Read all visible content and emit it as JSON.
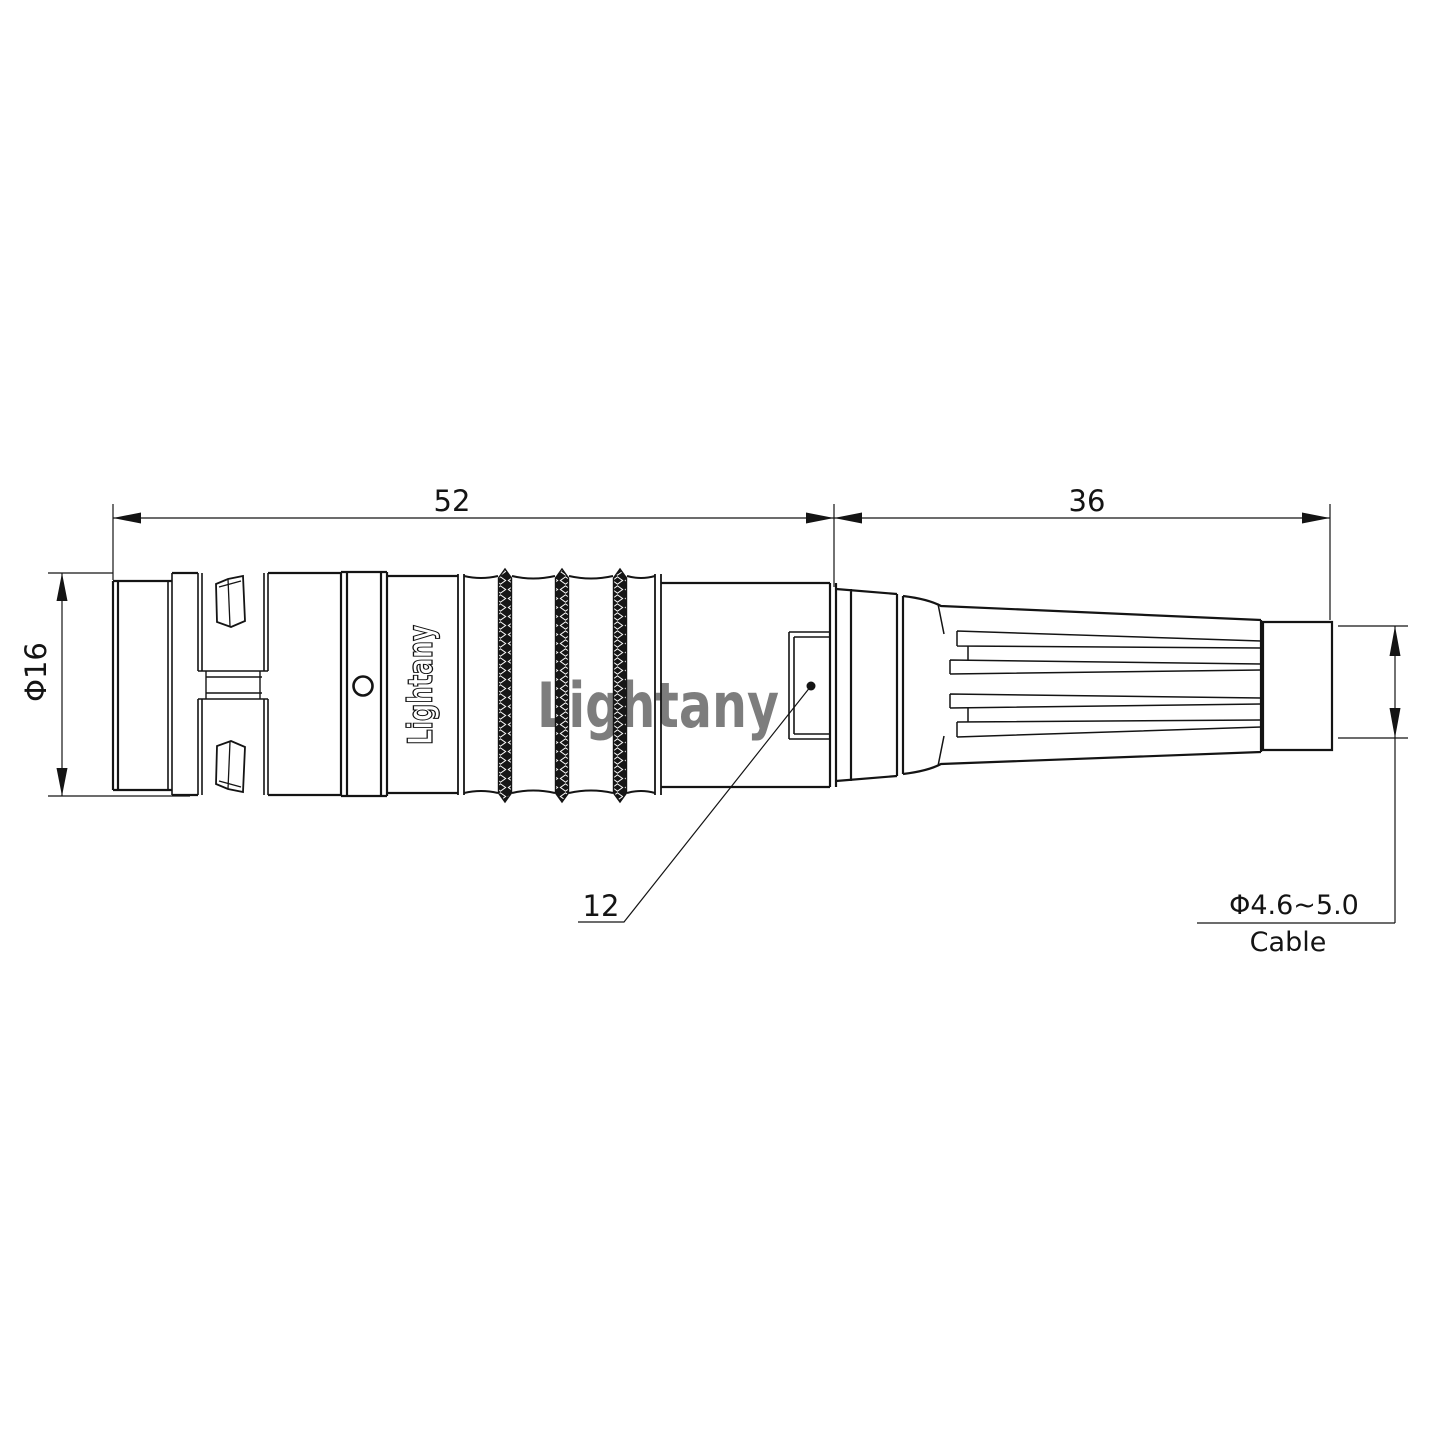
{
  "watermark": {
    "text": "Lightany",
    "color": "#f0a0a0"
  },
  "part": {
    "shell_marking": "Lightany"
  },
  "dimensions": {
    "front_length": "52",
    "rear_length": "36",
    "shell_diameter": "Φ16",
    "window_size": "12",
    "cable": {
      "diameter": "Φ4.6~5.0",
      "label": "Cable"
    }
  },
  "colors": {
    "line": "#141414",
    "background": "#ffffff"
  }
}
